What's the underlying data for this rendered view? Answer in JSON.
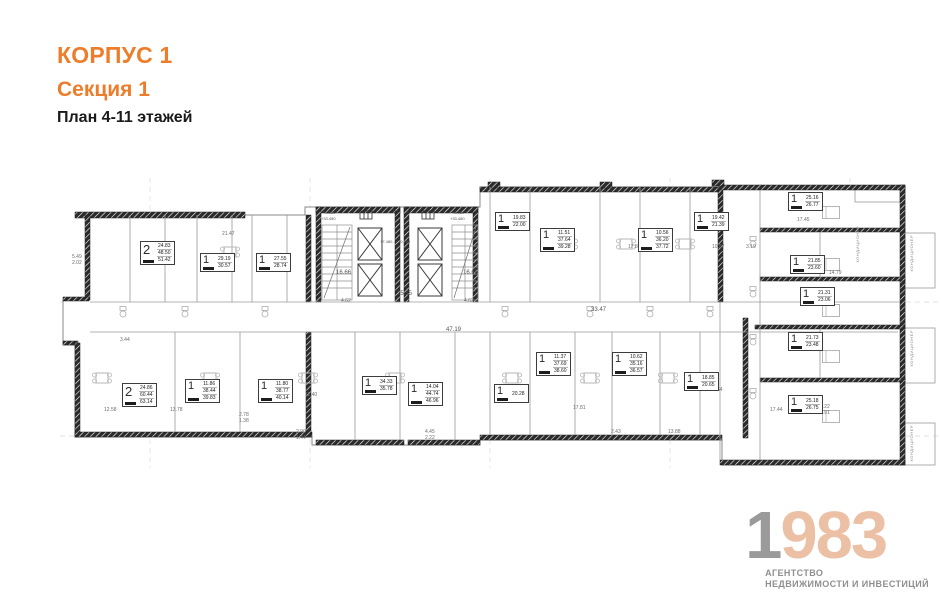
{
  "header": {
    "building": "КОРПУС 1",
    "section": "Секция 1",
    "plan_title": "План 4-11 этажей"
  },
  "colors": {
    "accent_orange": "#ED7D2B",
    "wall_black": "#1d1d1d",
    "thin_line": "#9a9a9a",
    "logo_gray": "#9a9a9a",
    "logo_peach": "#ecc0a5",
    "logo_text_gray": "#8f8f8f"
  },
  "plan": {
    "apartments": [
      {
        "type": "2",
        "areas": [
          "24.83",
          "48.50",
          "51.42"
        ],
        "x": 80,
        "y": 63
      },
      {
        "type": "1",
        "areas": [
          "29.19",
          "30.57"
        ],
        "x": 140,
        "y": 75
      },
      {
        "type": "1",
        "areas": [
          "27.55",
          "28.74"
        ],
        "x": 196,
        "y": 75
      },
      {
        "type": "1",
        "areas": [
          "19.83",
          "22.00"
        ],
        "x": 435,
        "y": 34
      },
      {
        "type": "1",
        "areas": [
          "11.51",
          "37.64",
          "39.28"
        ],
        "x": 480,
        "y": 50
      },
      {
        "type": "1",
        "areas": [
          "10.56",
          "36.20",
          "37.72"
        ],
        "x": 578,
        "y": 50
      },
      {
        "type": "1",
        "areas": [
          "19.42",
          "21.39"
        ],
        "x": 634,
        "y": 34
      },
      {
        "type": "1",
        "areas": [
          "25.16",
          "26.77"
        ],
        "x": 728,
        "y": 14
      },
      {
        "type": "1",
        "areas": [
          "21.85",
          "23.60"
        ],
        "x": 730,
        "y": 77
      },
      {
        "type": "1",
        "areas": [
          "21.31",
          "23.06"
        ],
        "x": 740,
        "y": 109
      },
      {
        "type": "1",
        "areas": [
          "21.73",
          "23.48"
        ],
        "x": 728,
        "y": 154
      },
      {
        "type": "1",
        "areas": [
          "25.18",
          "26.75"
        ],
        "x": 728,
        "y": 217
      },
      {
        "type": "2",
        "areas": [
          "24.86",
          "60.44",
          "63.14"
        ],
        "x": 62,
        "y": 205
      },
      {
        "type": "1",
        "areas": [
          "11.86",
          "38.44",
          "39.83"
        ],
        "x": 125,
        "y": 201
      },
      {
        "type": "1",
        "areas": [
          "11.80",
          "38.77",
          "40.14"
        ],
        "x": 198,
        "y": 201
      },
      {
        "type": "1",
        "areas": [
          "34.33",
          "35.78"
        ],
        "x": 302,
        "y": 198
      },
      {
        "type": "1",
        "areas": [
          "14.04",
          "44.74",
          "46.96"
        ],
        "x": 348,
        "y": 204
      },
      {
        "type": "1",
        "areas": [
          "20.28"
        ],
        "x": 434,
        "y": 206
      },
      {
        "type": "1",
        "areas": [
          "11.37",
          "37.69",
          "38.60"
        ],
        "x": 476,
        "y": 174
      },
      {
        "type": "1",
        "areas": [
          "10.62",
          "35.16",
          "36.57"
        ],
        "x": 552,
        "y": 174
      },
      {
        "type": "1",
        "areas": [
          "18.85",
          "20.65"
        ],
        "x": 624,
        "y": 194
      }
    ],
    "dimensions": [
      {
        "text": "21.47",
        "x": 162,
        "y": 54
      },
      {
        "text": "16.66",
        "x": 276,
        "y": 93,
        "big": true
      },
      {
        "text": "16.66",
        "x": 403,
        "y": 93,
        "big": true
      },
      {
        "text": "25.35",
        "x": 337,
        "y": 114,
        "big": true
      },
      {
        "text": "4.62",
        "x": 281,
        "y": 121
      },
      {
        "text": "4.62",
        "x": 404,
        "y": 121
      },
      {
        "text": "47.19",
        "x": 386,
        "y": 150,
        "big": true
      },
      {
        "text": "33.47",
        "x": 531,
        "y": 130,
        "big": true
      },
      {
        "text": "17.88",
        "x": 568,
        "y": 67
      },
      {
        "text": "17.45",
        "x": 737,
        "y": 40
      },
      {
        "text": "10.87",
        "x": 652,
        "y": 67
      },
      {
        "text": "3.19",
        "x": 686,
        "y": 67
      },
      {
        "text": "14.79",
        "x": 769,
        "y": 93
      },
      {
        "text": "12.64",
        "x": 650,
        "y": 210
      },
      {
        "text": "17.44",
        "x": 710,
        "y": 230
      },
      {
        "text": "8.22",
        "x": 760,
        "y": 227
      },
      {
        "text": "1.91",
        "x": 760,
        "y": 233
      },
      {
        "text": "17.81",
        "x": 513,
        "y": 228
      },
      {
        "text": "2.43",
        "x": 551,
        "y": 252
      },
      {
        "text": "13.88",
        "x": 608,
        "y": 252
      },
      {
        "text": "12.58",
        "x": 44,
        "y": 230
      },
      {
        "text": "13.78",
        "x": 110,
        "y": 230
      },
      {
        "text": "2.78",
        "x": 179,
        "y": 235
      },
      {
        "text": "1.38",
        "x": 179,
        "y": 241
      },
      {
        "text": "11.40",
        "x": 245,
        "y": 215
      },
      {
        "text": "2.90",
        "x": 236,
        "y": 252
      },
      {
        "text": "1.44",
        "x": 236,
        "y": 258
      },
      {
        "text": "4.45",
        "x": 365,
        "y": 252
      },
      {
        "text": "2.22",
        "x": 365,
        "y": 258
      },
      {
        "text": "5.49",
        "x": 12,
        "y": 77
      },
      {
        "text": "2.02",
        "x": 12,
        "y": 83
      },
      {
        "text": "3.44",
        "x": 60,
        "y": 160
      }
    ],
    "elevations": [
      {
        "text": "+8.880",
        "x": 263,
        "y": 33
      },
      {
        "text": "+33.480",
        "x": 261,
        "y": 39
      },
      {
        "text": "+8.880",
        "x": 392,
        "y": 33
      },
      {
        "text": "+33.480",
        "x": 390,
        "y": 39
      },
      {
        "text": "+7.480...+30.280",
        "x": 320,
        "y": 62
      }
    ],
    "ac_labels": [
      {
        "text": "КОНДИЦИОНЕР",
        "x": 849,
        "y": 57
      },
      {
        "text": "КОНДИЦИОНЕР",
        "x": 849,
        "y": 152
      },
      {
        "text": "КОНДИЦИОНЕР",
        "x": 849,
        "y": 247
      },
      {
        "text": "КОНДИЦИОНЕР",
        "x": 795,
        "y": 48
      }
    ]
  },
  "logo": {
    "year_gray": "1",
    "year_peach": "983",
    "line1": "АГЕНТСТВО",
    "line2": "НЕДВИЖИМОСТИ И ИНВЕСТИЦИЙ"
  }
}
